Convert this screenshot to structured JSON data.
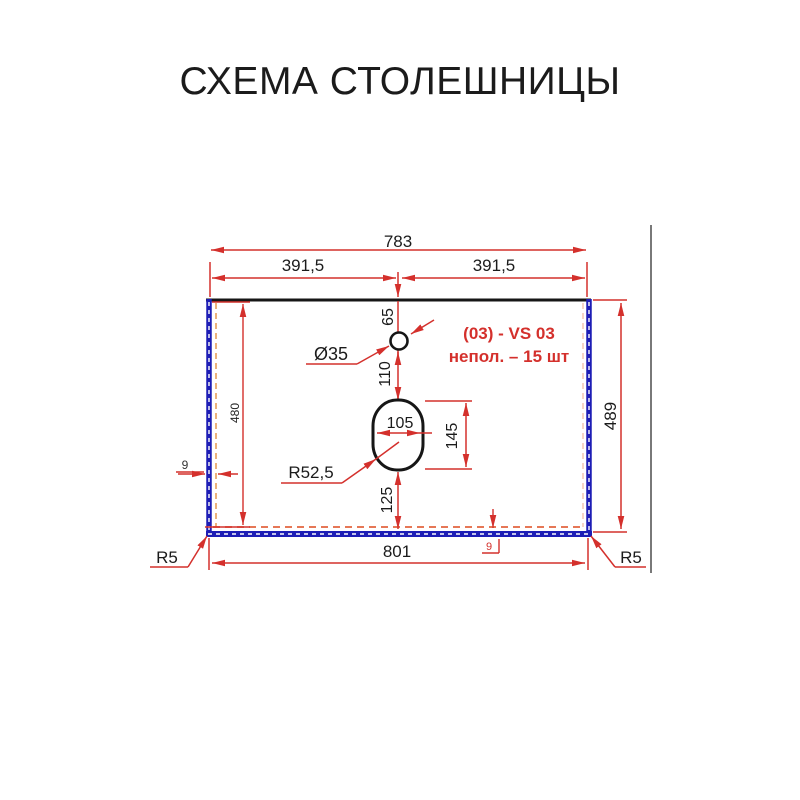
{
  "title": "СХЕМА СТОЛЕШНИЦЫ",
  "colors": {
    "dimension_red": "#d4302c",
    "edge_blue": "#1d1db5",
    "outline_black": "#161616",
    "dash_orange": "#e8a05c",
    "dash_bottom": "#e2643e",
    "frame_gray": "#4d4d4d"
  },
  "drawing": {
    "top": {
      "total": "783",
      "half_left": "391,5",
      "half_right": "391,5"
    },
    "faucet": {
      "offset_label": "65",
      "diameter_label": "Ø35",
      "to_sink_label": "110"
    },
    "annotation": {
      "line1": "(03) - VS 03",
      "line2": "непол. – 15 шт"
    },
    "sink": {
      "width_label": "105",
      "height_label": "145",
      "radius_label": "R52,5",
      "bottom_offset_label": "125"
    },
    "left_side": {
      "height_label": "480",
      "edge_thickness_label": "9"
    },
    "right_side": {
      "height_label": "489"
    },
    "bottom": {
      "total": "801",
      "edge_thickness_label": "9",
      "corner_left": "R5",
      "corner_right": "R5"
    }
  }
}
